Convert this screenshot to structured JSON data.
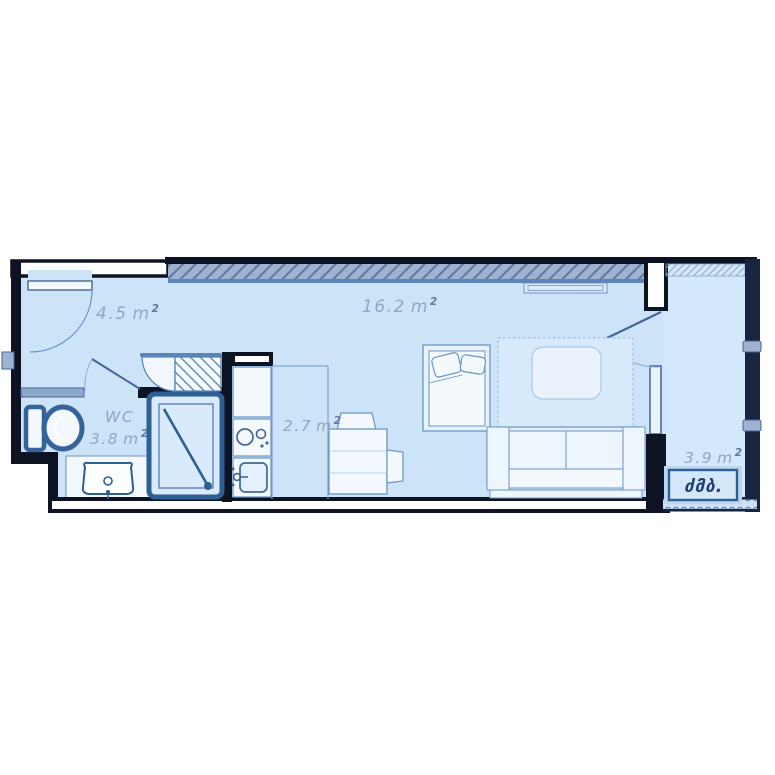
{
  "plan": {
    "kind": "studio-apartment-floor-plan",
    "rooms": [
      {
        "id": "entry-hall",
        "area": "4.5",
        "unit": "m",
        "sup": "2"
      },
      {
        "id": "living-room",
        "area": "16.2",
        "unit": "m",
        "sup": "2"
      },
      {
        "id": "wc",
        "name": "WC",
        "area": "3.8",
        "unit": "m",
        "sup": "2"
      },
      {
        "id": "kitchen",
        "area": "2.7",
        "unit": "m",
        "sup": "2"
      },
      {
        "id": "balcony",
        "area": "3.9",
        "unit": "m",
        "sup": "2"
      }
    ],
    "logo": {
      "text": "ძმბ."
    },
    "symbols": [
      "entry-door",
      "wc-door",
      "balcony-door",
      "wardrobe-shelves",
      "shower-cabin",
      "toilet",
      "washbasin",
      "kitchen-counter",
      "stove-burners",
      "kitchen-sink",
      "desk",
      "chair",
      "bed",
      "pillows",
      "rug",
      "coffee-table",
      "sofa",
      "radiator",
      "glazed-wall",
      "balcony-railing"
    ],
    "colors": {
      "wall": "#0d1322",
      "floor": "#cde4f8",
      "balcony_floor": "#d3e8fa",
      "accent_bold": "#2e5f94",
      "fixture_stroke": "#44659a",
      "furniture_stroke": "#6b94c4",
      "furniture_fill": "#eff6fd",
      "hatch_fill": "#9fb3d1",
      "hatch_line": "#5f7aa6",
      "glazing": "#192540",
      "label_text": "#8ea6c4",
      "logo_text": "#1d3f73",
      "logo_frame": "#bed6ed"
    }
  }
}
